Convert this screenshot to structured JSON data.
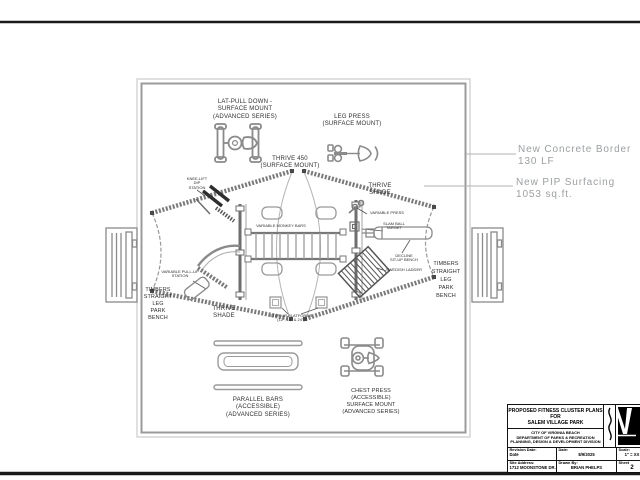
{
  "plan": {
    "labels": {
      "lat_pull_down": "LAT-PULL DOWN -\nSURFACE MOUNT\n(ADVANCED SERIES)",
      "leg_press": "LEG PRESS\n(SURFACE MOUNT)",
      "thrive_450": "THRIVE 450\n(SURFACE MOUNT)",
      "knee_lift_dip": "KNEE-LIFT\nDIP\nSTATION",
      "thrive_shade_ne": "THRIVE\nSHADE",
      "variable_press": "VARIABLE PRESS",
      "slam_ball_target": "SLAM BALL\nTARGET",
      "variable_monkey_bars": "VARIABLE MONKEY BARS",
      "decline_situp_bench": "DECLINE\nSIT-UP BENCH",
      "swedish_ladder": "SWEDISH LADDER",
      "variable_pullup_station": "VARIABLE PULL-UP\nSTATION",
      "bench_left": "TIMBERS\nSTRAIGHT\nLEG\nPARK\nBENCH",
      "bench_right": "TIMBERS\nSTRAIGHT\nLEG\nPARK\nBENCH",
      "thrive_shade_sw": "THRIVE\nSHADE",
      "step_up_platforms": "STEP-UP PLATFORMS\n(12\", 18\" & 24\")",
      "parallel_bars": "PARALLEL BARS\n(ACCESSIBLE)\n(ADVANCED SERIES)",
      "chest_press": "CHEST PRESS\n(ACCESSIBLE)\nSURFACE MOUNT\n(ADVANCED SERIES)"
    }
  },
  "annotations": {
    "concrete_border": "New Concrete Border\n130 LF",
    "pip_surfacing": "New PIP Surfacing\n1053 sq.ft."
  },
  "title_block": {
    "line1": "PROPOSED FITNESS CLUSTER PLANS",
    "line2": "FOR",
    "line3": "SALEM VILLAGE PARK",
    "agency": "CITY OF VIRGINIA BEACH\nDEPARTMENT OF PARKS & RECREATION\nPLANNING, DESIGN & DEVELOPMENT DIVISION",
    "fields": {
      "revision_date_label": "Revision Date:",
      "revision_date_value": "Date",
      "date_label": "Date:",
      "date_value": "8/9/2025",
      "scale_label": "Scale:",
      "scale_value": "1\" = XX",
      "site_address_label": "Site Address:",
      "site_address_value": "1712 MOONSTONE DR.",
      "drawn_by_label": "Drawn By:",
      "drawn_by_value": "BRIAN PHELPS",
      "sheet_label": "Sheet",
      "sheet_value": "2"
    }
  },
  "icons": {
    "vb_logo": "virginia-beach-flag-logo",
    "squiggle": "wave-divider"
  },
  "colors": {
    "frame_black": "#1a1a1a",
    "drawing_gray": "#8a8a8a",
    "beam_gray": "#7a7a7a",
    "annotation_gray": "#9b9fa1",
    "border_light": "#c9c9c9",
    "border_mid": "#9b9b9b"
  }
}
